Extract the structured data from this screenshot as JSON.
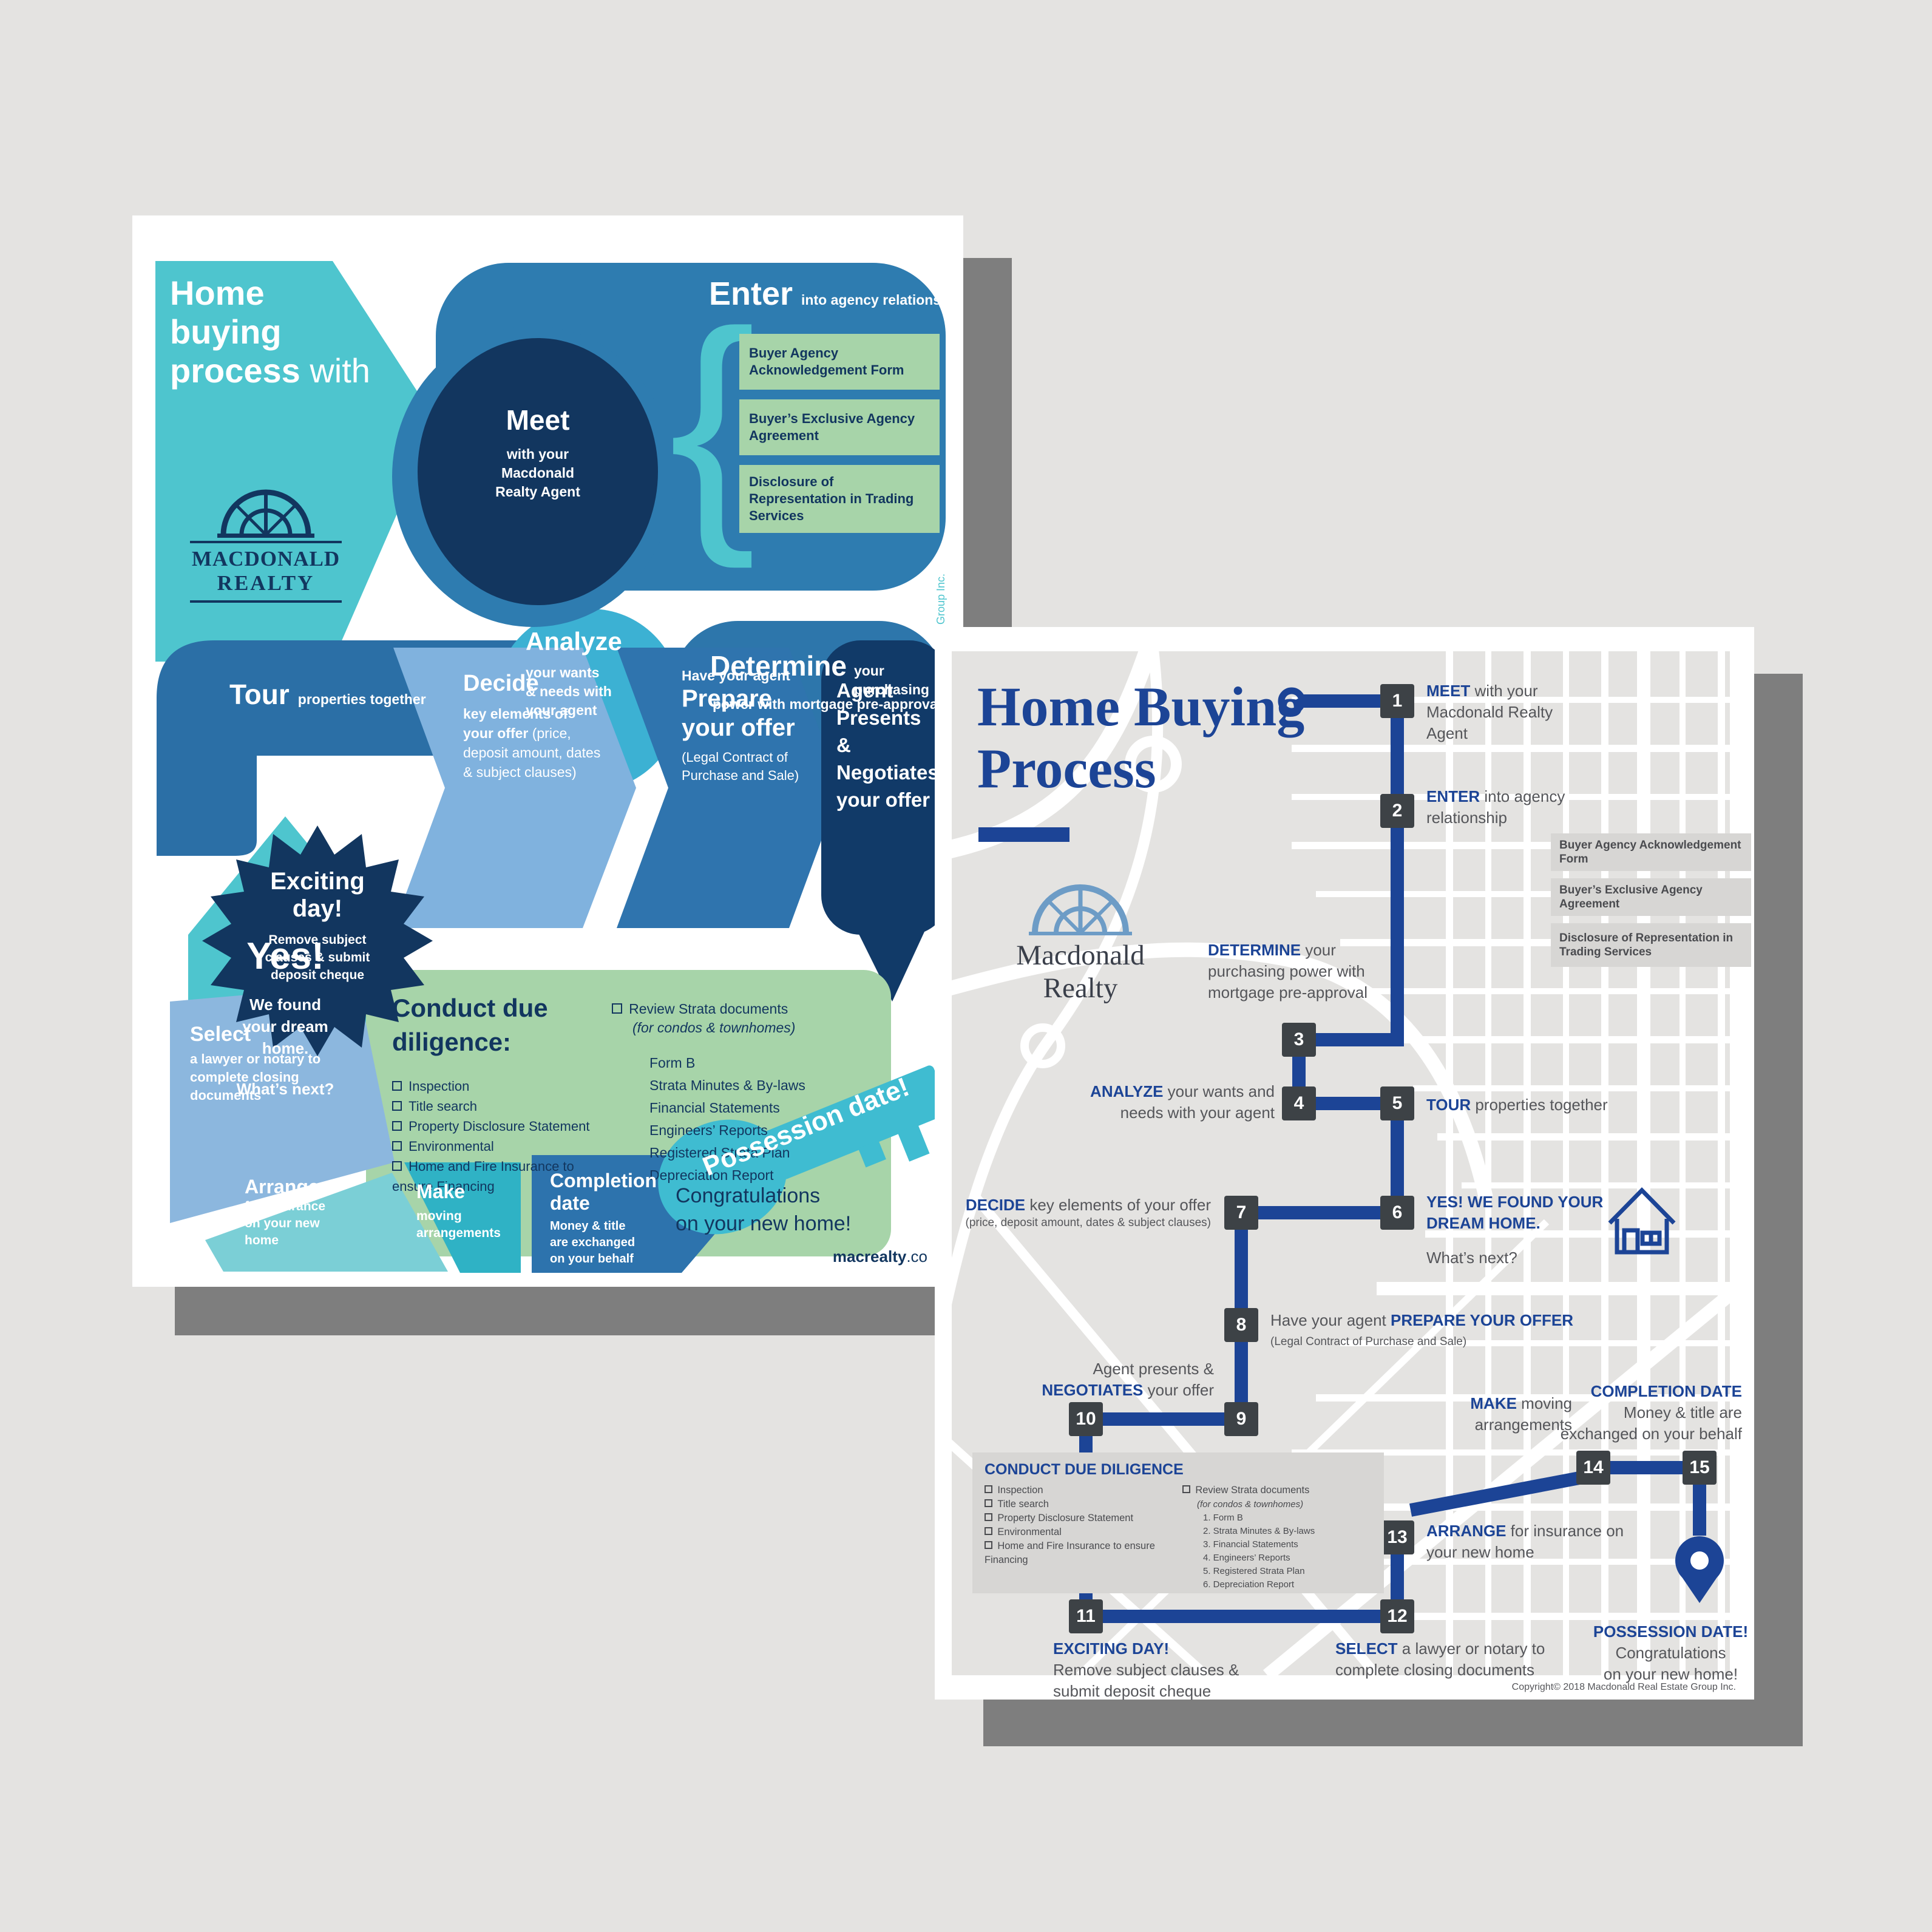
{
  "colors": {
    "background": "#e4e3e1",
    "shadow": "#7e7e7e",
    "teal": "#4ec5ce",
    "navy": "#12365f",
    "mid_blue": "#2e7cb0",
    "cyan": "#3cb1d3",
    "light_blue": "#80b2de",
    "green": "#a7d4a9",
    "royal_blue": "#1c4496",
    "step_square": "#3d4246",
    "body_gray": "#55565a"
  },
  "left": {
    "header": {
      "t1": "Home",
      "t2": "buying",
      "t3": "process",
      "with": " with"
    },
    "logo": {
      "l1": "MACDONALD",
      "l2": "REALTY"
    },
    "meet": {
      "title": "Meet",
      "lines": [
        "with your",
        "Macdonald",
        "Realty Agent"
      ]
    },
    "enter": {
      "title": "Enter",
      "sub": "into agency relationship",
      "brace": "{",
      "docs": [
        "Buyer Agency Acknowledgement Form",
        "Buyer’s Exclusive Agency Agreement",
        "Disclosure of Representation in Trading Services"
      ]
    },
    "tour": {
      "title": "Tour",
      "sub": "properties together"
    },
    "analyze": {
      "title": "Analyze",
      "lines": [
        "your wants",
        "& needs with",
        "your agent"
      ]
    },
    "determine": {
      "title": "Determine",
      "sub1": " your purchasing",
      "sub2": "power with mortgage pre-approval"
    },
    "yes": {
      "title": "Yes!",
      "lines": [
        "We found",
        "your dream",
        "home."
      ],
      "next": "What’s next?"
    },
    "decide": {
      "title": "Decide",
      "l1": "key elements of",
      "l2b": "your offer",
      "l2r": " (price,",
      "l3": "deposit amount, dates",
      "l4": "& subject clauses)"
    },
    "prepare": {
      "pre": "Have your agent",
      "t1": "Prepare",
      "t2": "your offer",
      "n1": "(Legal Contract of",
      "n2": "Purchase and Sale)"
    },
    "agent": {
      "lines": [
        "Agent",
        "Presents &",
        "Negotiates",
        "your offer"
      ]
    },
    "diligence": {
      "t1": "Conduct due",
      "t2": "diligence:",
      "left_items": [
        "Inspection",
        "Title search",
        "Property Disclosure Statement",
        "Environmental",
        "Home and Fire Insurance to ensure Financing"
      ],
      "r_head": "Review Strata documents",
      "r_note": "(for condos & townhomes)",
      "r_items": [
        "Form B",
        "Strata Minutes & By-laws",
        "Financial Statements",
        "Engineers’ Reports",
        "Registered Strata Plan",
        "Depreciation Report"
      ]
    },
    "exciting": {
      "t1": "Exciting",
      "t2": "day!",
      "sub": [
        "Remove subject",
        "clauses & submit",
        "deposit cheque"
      ]
    },
    "select": {
      "title": "Select",
      "sub": [
        "a lawyer or notary to",
        "complete closing",
        "documents"
      ]
    },
    "arrange": {
      "title": "Arrange",
      "sub": [
        "for insurance",
        "on your new",
        "home"
      ]
    },
    "make": {
      "title": "Make",
      "sub": [
        "moving",
        "arrangements"
      ]
    },
    "completion": {
      "t1": "Completion",
      "t2": "date",
      "sub": [
        "Money & title",
        "are exchanged",
        "on your behalf"
      ]
    },
    "possession": {
      "key_label": "Possession date!",
      "congrats1": "Congratulations",
      "congrats2": "on your new home!"
    },
    "site": {
      "b": "macrealty",
      "r": ".co"
    },
    "credit": "y Group Inc."
  },
  "right": {
    "title1": "Home Buying",
    "title2": "Process",
    "logo1": "Macdonald",
    "logo2": "Realty",
    "steps": [
      {
        "n": "1",
        "pre": "",
        "bold": "MEET",
        "post": " with your Macdonald Realty Agent",
        "note": ""
      },
      {
        "n": "2",
        "pre": "",
        "bold": "ENTER",
        "post": " into agency relationship",
        "note": ""
      },
      {
        "n": "3",
        "pre": "",
        "bold": "DETERMINE",
        "post": " your purchasing power with mortgage pre-approval",
        "note": ""
      },
      {
        "n": "4",
        "pre": "",
        "bold": "ANALYZE",
        "post": " your wants and needs with your agent",
        "note": ""
      },
      {
        "n": "5",
        "pre": "",
        "bold": "TOUR",
        "post": " properties together",
        "note": ""
      },
      {
        "n": "6",
        "pre": "",
        "bold": "YES! WE FOUND YOUR DREAM HOME.",
        "post": "",
        "note": "",
        "post2": "What’s next?"
      },
      {
        "n": "7",
        "pre": "",
        "bold": "DECIDE",
        "post": " key elements of your offer",
        "note": "(price, deposit amount, dates & subject clauses)"
      },
      {
        "n": "8",
        "pre": "Have your agent ",
        "bold": "PREPARE YOUR OFFER",
        "post": "",
        "note": "(Legal Contract of Purchase and Sale)"
      },
      {
        "n": "9",
        "pre": "Agent presents & ",
        "bold": "NEGOTIATES",
        "post": " your offer",
        "note": ""
      },
      {
        "n": "10",
        "pre": "",
        "bold": "",
        "post": "",
        "note": ""
      },
      {
        "n": "11",
        "pre": "",
        "bold": "EXCITING DAY!",
        "post": "Remove subject clauses & submit deposit cheque",
        "note": ""
      },
      {
        "n": "12",
        "pre": "",
        "bold": "SELECT",
        "post": " a lawyer or notary to complete closing documents",
        "note": ""
      },
      {
        "n": "13",
        "pre": "",
        "bold": "ARRANGE",
        "post": " for insurance on your new home",
        "note": ""
      },
      {
        "n": "14",
        "pre": "",
        "bold": "MAKE",
        "post": " moving arrangements",
        "note": ""
      },
      {
        "n": "15",
        "pre": "",
        "bold": "COMPLETION DATE",
        "post": "Money & title are exchanged on your behalf",
        "note": ""
      }
    ],
    "docs": [
      "Buyer Agency Acknowledgement Form",
      "Buyer’s Exclusive Agency Agreement",
      "Disclosure of Representation in Trading Services"
    ],
    "panel": {
      "title": "CONDUCT DUE DILIGENCE",
      "left_items": [
        "Inspection",
        "Title search",
        "Property Disclosure Statement",
        "Environmental",
        "Home and Fire Insurance to ensure Financing"
      ],
      "r_head": "Review Strata documents",
      "r_note": "(for condos & townhomes)",
      "r_items": [
        "1.   Form B",
        "2.   Strata Minutes & By-laws",
        "3.   Financial Statements",
        "4.   Engineers’ Reports",
        "5.   Registered Strata Plan",
        "6.   Depreciation Report"
      ]
    },
    "possession": {
      "bold": "POSSESSION DATE!",
      "l1": "Congratulations",
      "l2": "on your new home!"
    },
    "copyright": "Copyright© 2018 Macdonald Real Estate Group Inc."
  }
}
